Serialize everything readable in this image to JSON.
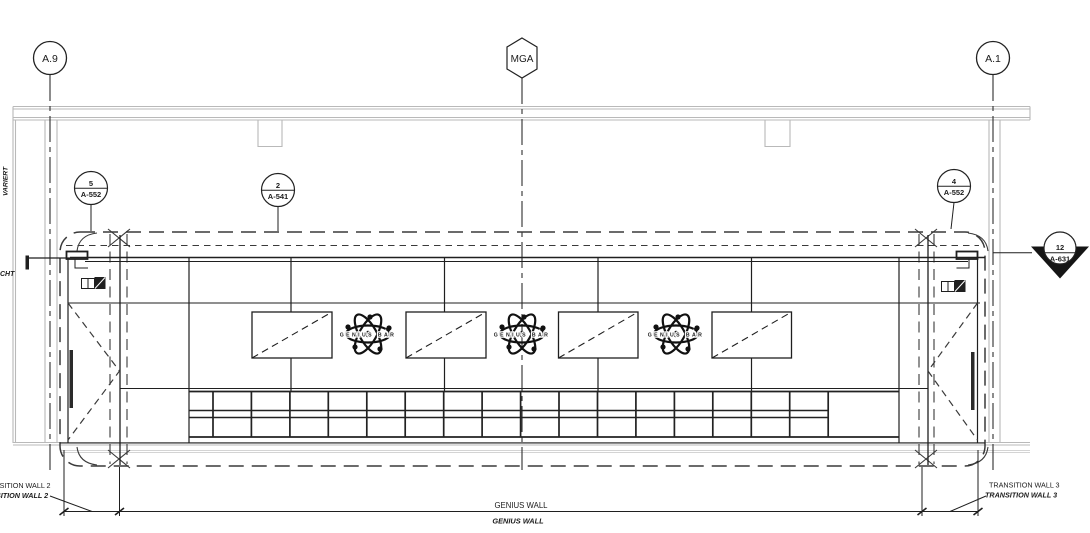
{
  "grid": {
    "a9": "A.9",
    "mga": "MGA",
    "a1": "A.1"
  },
  "callouts": {
    "c5": {
      "num": "5",
      "sheet": "A-552"
    },
    "c2": {
      "num": "2",
      "sheet": "A-541"
    },
    "c4": {
      "num": "4",
      "sheet": "A-552"
    },
    "s12": {
      "num": "12",
      "sheet": "A-631"
    }
  },
  "logo": {
    "text": "GENIUS BAR"
  },
  "labels": {
    "transition_wall_2": "TRANSITION WALL 2",
    "transition_wall_2_italic": "TRANSITION WALL 2",
    "genius_wall": "GENIUS WALL",
    "genius_wall_italic": "GENIUS WALL",
    "transition_wall_3": "TRANSITION WALL 3",
    "transition_wall_3_italic": "TRANSITION WALL 3",
    "edge_vertical": "VARIERT",
    "edge_fragment": "CHT"
  },
  "colors": {
    "line_dark": "#1f1f1f",
    "line_medium": "#3a3a3a",
    "line_light": "#b9b9b9",
    "background": "#ffffff"
  }
}
